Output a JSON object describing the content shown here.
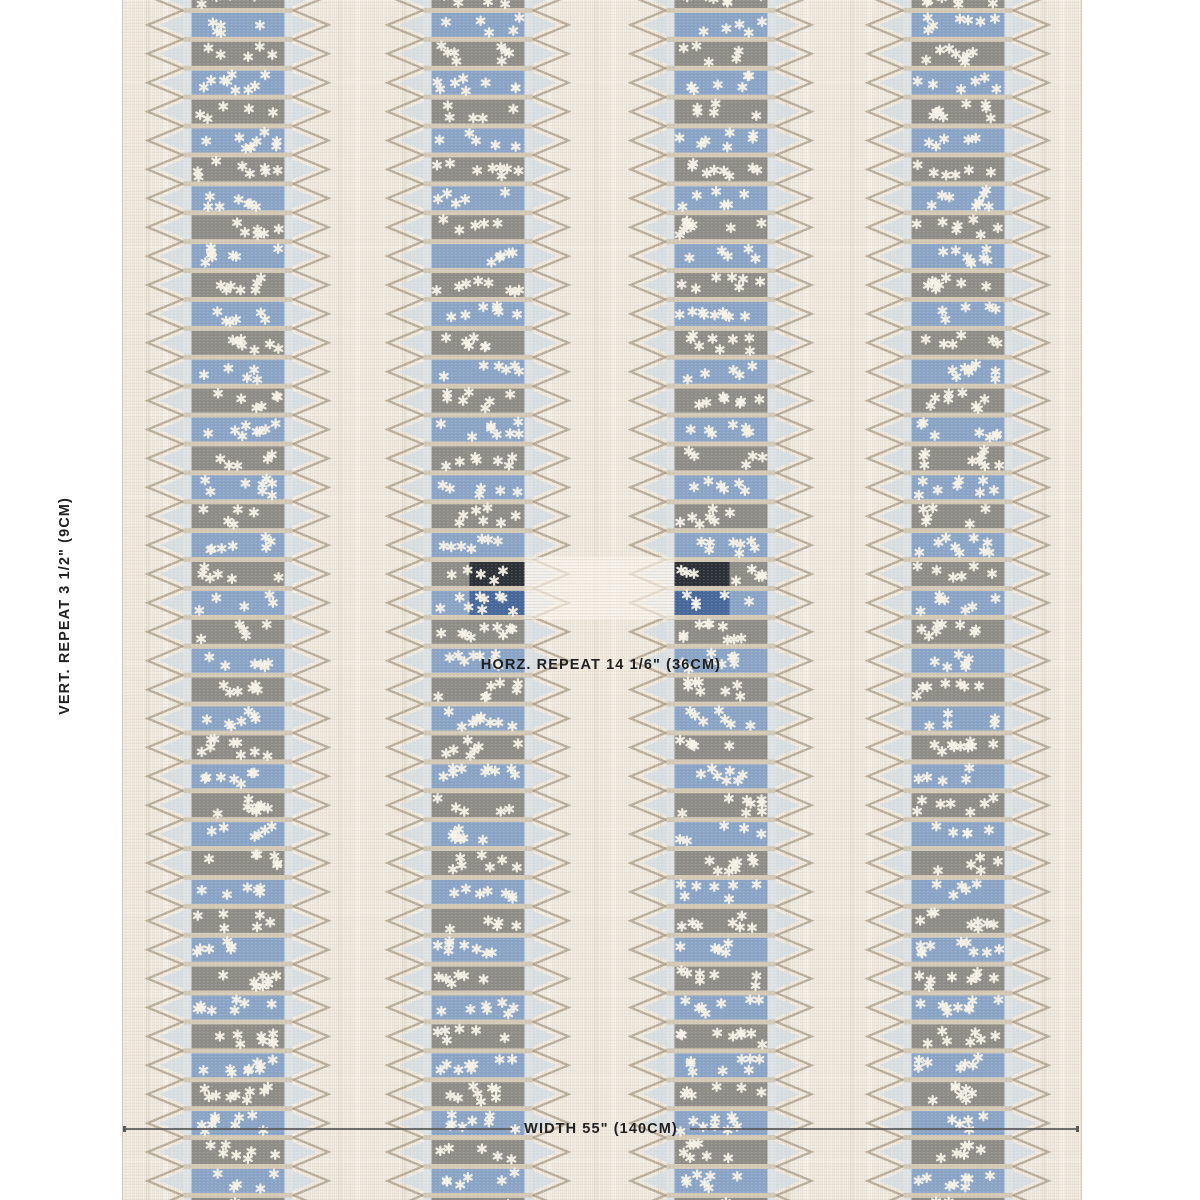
{
  "labels": {
    "vertical_repeat": "VERT. REPEAT 3 1/2\" (9CM)",
    "horizontal_repeat": "HORZ. REPEAT 14 1/6\" (36CM)",
    "width": "WIDTH 55\" (140CM)"
  },
  "swatch": {
    "colors": {
      "page_background": "#ffffff",
      "fabric_background": "#ebe4d6",
      "band_blue": "#8aa4c6",
      "band_gray": "#8d8c86",
      "band_separator": "#cfc3ae",
      "star": "#f5f2e7",
      "chevron_outline": "#ab9e89",
      "chevron_fill": "#d6dde2",
      "edge_strip": "#dce1e4",
      "marker_dark_top": "#252a32",
      "marker_dark_bottom": "#3e6095",
      "marker_ribbon": "rgba(253,250,243,0.62)",
      "label_text": "#202020",
      "measure_line": "#585858"
    },
    "pattern": {
      "fabric_left": 122,
      "fabric_width": 958,
      "fabric_height": 1200,
      "column_centers": [
        237,
        477,
        720,
        957
      ],
      "stack_width": 93,
      "strip_width": 8,
      "band_height": 24,
      "separator_height": 4.9,
      "row_pitch": 28.9,
      "first_row_top": -16,
      "chevron_outline_depth": 36,
      "chevron_fill_depth": 24,
      "marker_rows": [
        20,
        21
      ],
      "marker_patch_width": 55,
      "marker_ribbon_y": 557,
      "marker_ribbon_height": 62,
      "star_seed": 7
    },
    "measure": {
      "line_y": 1129,
      "vert_label_x": 65,
      "vert_label_y": 606,
      "horz_label_x": 601,
      "horz_label_y": 665
    }
  }
}
